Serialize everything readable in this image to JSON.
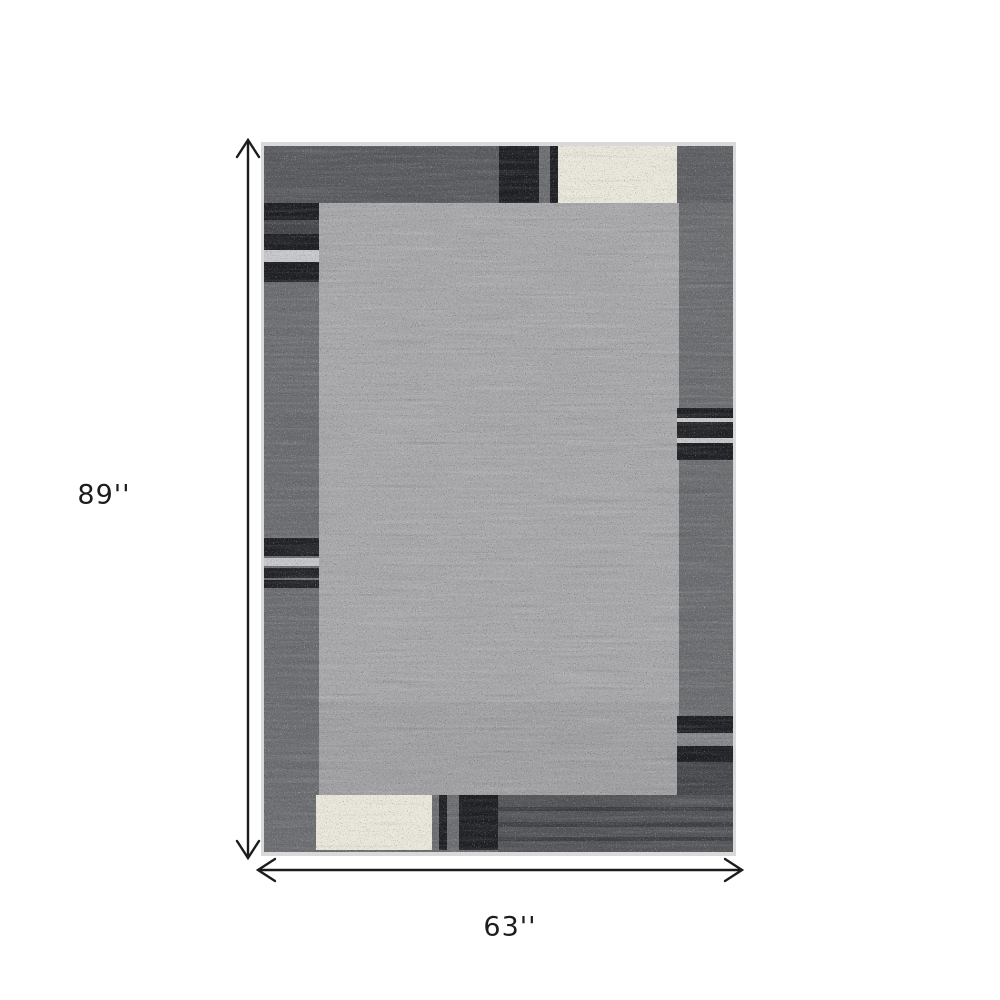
{
  "background_color": "#ffffff",
  "dimensions": {
    "height_label": "89''",
    "width_label": "63''"
  },
  "annotation": {
    "arrow_color": "#1c1c1e"
  },
  "rug": {
    "description": "gray area rug with dark gray border, black and ivory accent blocks and stripes",
    "colors": {
      "binding": "#d9d9d9",
      "border": "#6b6d70",
      "border_dark": "#595b5f",
      "corner_dark": "#5e6064",
      "field": "#a7a7aa",
      "accent_black": "#1f2024",
      "accent_cream": "#e9e6da",
      "accent_light": "#c6c6c8",
      "stripe_charcoal": "#45474b",
      "stripe_medium": "#85868a",
      "bottom_dark": "#54565a"
    }
  }
}
